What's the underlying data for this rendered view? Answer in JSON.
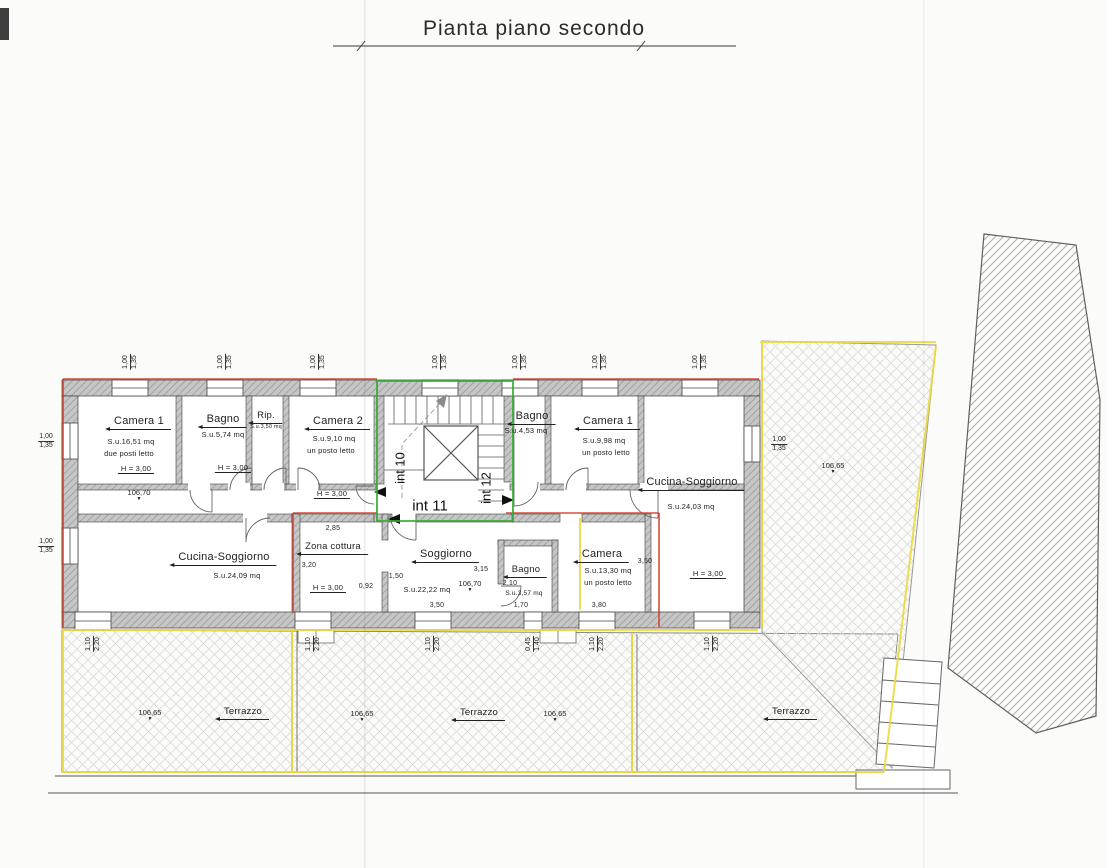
{
  "title": "Pianta piano secondo",
  "units": {
    "int10": "int 10",
    "int11": "int 11",
    "int12": "int 12"
  },
  "rooms": {
    "camera1_nw": {
      "name": "Camera 1",
      "area": "S.u.16,51 mq",
      "beds": "due posti letto",
      "height": "H = 3,00",
      "elev": "106,70"
    },
    "bagno_nw": {
      "name": "Bagno",
      "area": "S.u.5,74 mq",
      "height": "H = 3,00"
    },
    "rip": {
      "name": "Rip.",
      "area": "S.u.3,50 mq"
    },
    "camera2": {
      "name": "Camera 2",
      "area": "S.u.9,10 mq",
      "beds": "un posto letto",
      "height": "H = 3,00"
    },
    "bagno_ne": {
      "name": "Bagno",
      "area": "S.u.4,53 mq"
    },
    "camera1_ne": {
      "name": "Camera 1",
      "area": "S.u.9,98 mq",
      "beds": "un posto letto"
    },
    "cucina_e": {
      "name": "Cucina-Soggiorno",
      "area": "S.u.24,03 mq",
      "height": "H = 3,00"
    },
    "cucina_sw": {
      "name": "Cucina-Soggiorno",
      "area": "S.u.24,09 mq"
    },
    "zona_cottura": {
      "name": "Zona cottura",
      "height": "H = 3,00"
    },
    "soggiorno": {
      "name": "Soggiorno",
      "area": "S.u.22,22 mq",
      "elev": "106,70"
    },
    "bagno_s": {
      "name": "Bagno",
      "area": "S.u.3,57 mq"
    },
    "camera_s": {
      "name": "Camera",
      "area": "S.u.13,30 mq",
      "beds": "un posto letto"
    }
  },
  "terrace": {
    "label": "Terrazzo",
    "elev": "106,65"
  },
  "dims": {
    "win_top_w": "1,00",
    "win_top_h": "1,35",
    "win_bot_w": "1,10",
    "win_bot_h": "2,20",
    "win_small_w": "0,45",
    "win_small_h": "1,40",
    "zona_w": "2,85",
    "zona_d": "3,20",
    "pass_a": "0,92",
    "pass_b": "1,50",
    "sogg_d": "3,15",
    "sogg_w": "3,50",
    "bagno_s_w": "2,10",
    "bagno_s_d": "1,70",
    "camera_s_d": "3,50",
    "camera_s_w": "3,80"
  }
}
